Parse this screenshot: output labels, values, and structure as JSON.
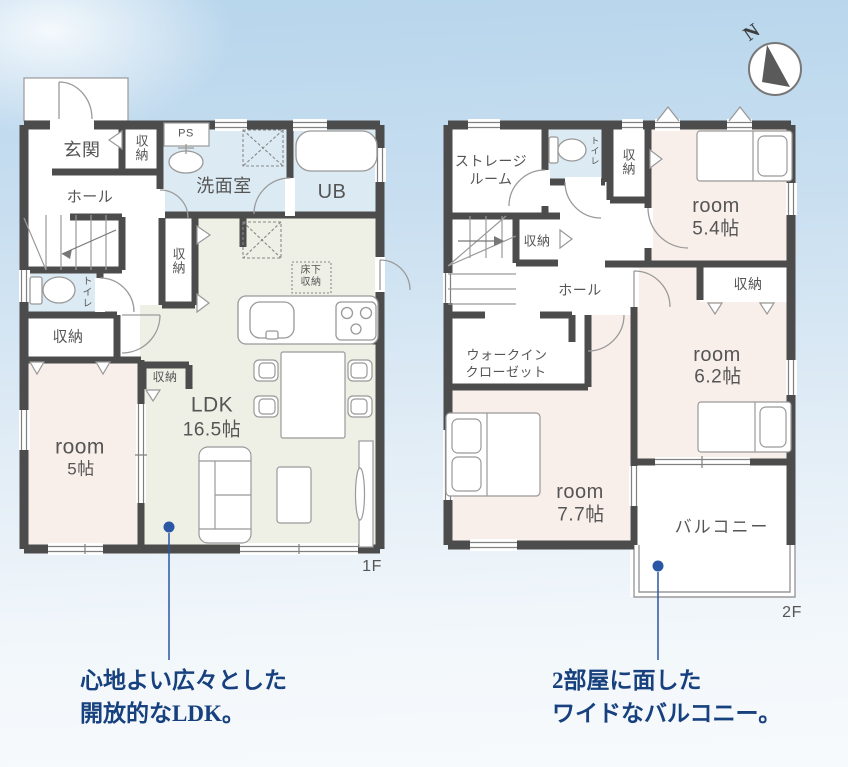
{
  "compass": {
    "north_label": "N"
  },
  "floor1": {
    "floor_label": "1F",
    "labels": {
      "genkan": "玄関",
      "genkan_closet": "収納",
      "ps": "PS",
      "washroom": "洗面室",
      "bath": "UB",
      "hall": "ホール",
      "toilet": "トイレ",
      "hall_closet": "収納",
      "toilet_closet": "収納",
      "ldk_closet": "収納",
      "underfloor_line1": "床下",
      "underfloor_line2": "収納",
      "ldk_name": "LDK",
      "ldk_size": "16.5帖",
      "room_name": "room",
      "room_size": "5帖"
    }
  },
  "floor2": {
    "floor_label": "2F",
    "labels": {
      "storage_room_line1": "ストレージ",
      "storage_room_line2": "ルーム",
      "toilet": "トイレ",
      "closet_top": "収納",
      "room54_name": "room",
      "room54_size": "5.4帖",
      "closet_54": "収納",
      "closet_mid": "収納",
      "hall": "ホール",
      "wic_line1": "ウォークイン",
      "wic_line2": "クローゼット",
      "room62_name": "room",
      "room62_size": "6.2帖",
      "room77_name": "room",
      "room77_size": "7.7帖",
      "balcony": "バルコニー"
    }
  },
  "captions": {
    "ldk": {
      "line1": "心地よい広々とした",
      "line2": "開放的なLDK。"
    },
    "balcony": {
      "line1": "2部屋に面した",
      "line2": "ワイドなバルコニー。"
    }
  },
  "colors": {
    "wall": "#4c4c4c",
    "wet_room": "#dcebf3",
    "ldk": "#eef0e5",
    "bedroom": "#f8efea",
    "caption": "#17417e",
    "callout_dot": "#2a57a5"
  }
}
